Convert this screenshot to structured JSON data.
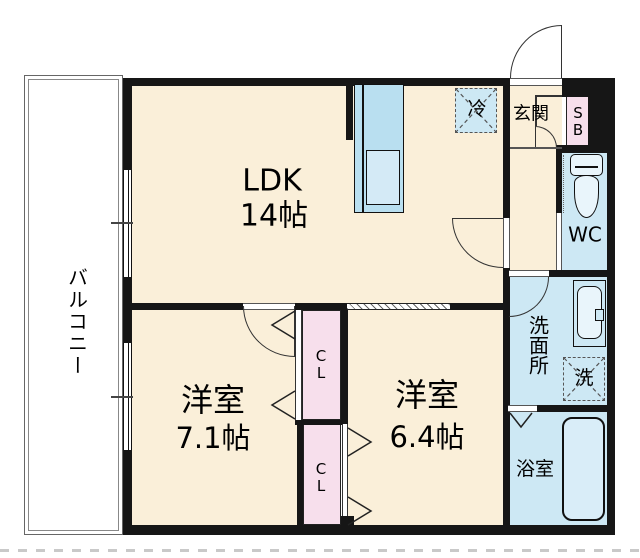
{
  "plan_type": "floorplan-2LDK",
  "rooms": {
    "ldk": {
      "name": "LDK",
      "area": "14帖"
    },
    "bedroom_left": {
      "name": "洋室",
      "area": "7.1帖"
    },
    "bedroom_right": {
      "name": "洋室",
      "area": "6.4帖"
    },
    "entrance": {
      "name": "玄関"
    },
    "toilet": {
      "name": "WC"
    },
    "washroom": {
      "name": "洗面所"
    },
    "bathroom": {
      "name": "浴室"
    },
    "balcony": {
      "name": "バルコニー"
    }
  },
  "fixtures": {
    "refrigerator": "冷",
    "washing_machine": "洗",
    "shoe_box": "SB",
    "closet_upper": "CL",
    "closet_lower": "CL"
  },
  "colors": {
    "floor_cream": "#faefd9",
    "wet_area_blue": "#cde8f4",
    "closet_pink": "#f7dfec",
    "kitchen_blue": "#b9dff0",
    "wall_black": "#161616"
  }
}
